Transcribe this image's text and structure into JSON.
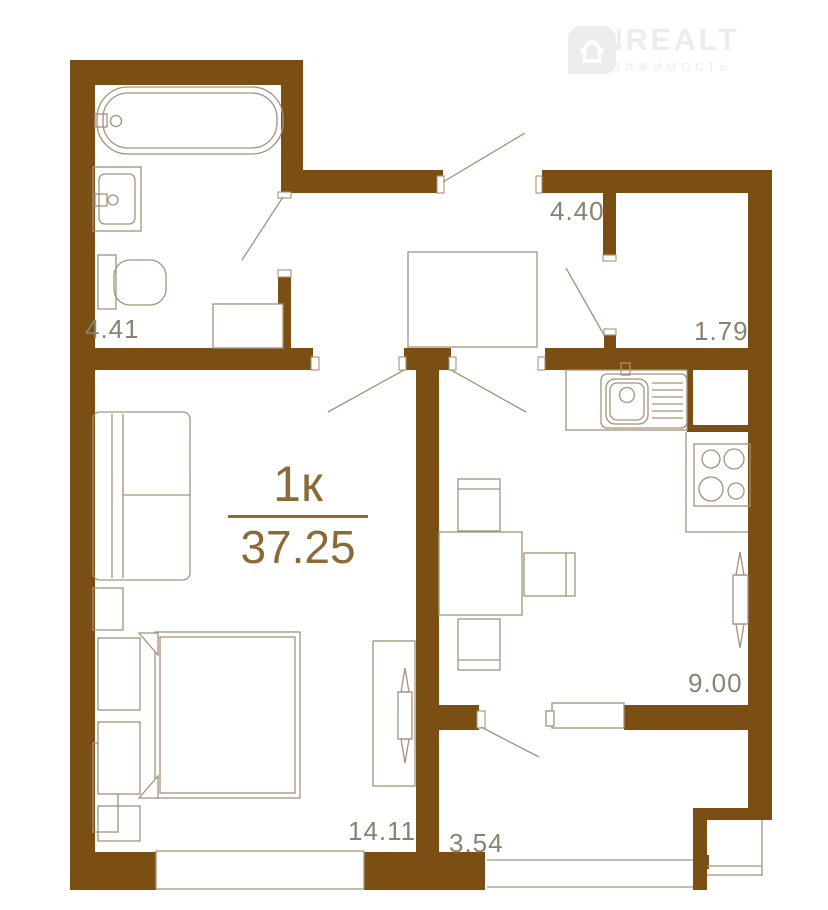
{
  "logo": {
    "name": "ONREALT",
    "subtitle": "НЕДВИЖИМОСТЬ",
    "icon": "house-pin-icon"
  },
  "unit": {
    "type_label": "1к",
    "area_total": "37.25"
  },
  "rooms": [
    {
      "id": "bathroom",
      "area": "4.41"
    },
    {
      "id": "hallway",
      "area": "4.40"
    },
    {
      "id": "wc-corridor",
      "area": "1.79"
    },
    {
      "id": "kitchen",
      "area": "9.00"
    },
    {
      "id": "living-room",
      "area": "14.11"
    },
    {
      "id": "corridor",
      "area": "3.54"
    }
  ],
  "colors": {
    "wall": "#7b4e14",
    "furniture_line": "#a39378",
    "label_text": "#8b8171",
    "accent_text": "#8a6b35",
    "logo": "#ededed",
    "background": "#ffffff"
  }
}
